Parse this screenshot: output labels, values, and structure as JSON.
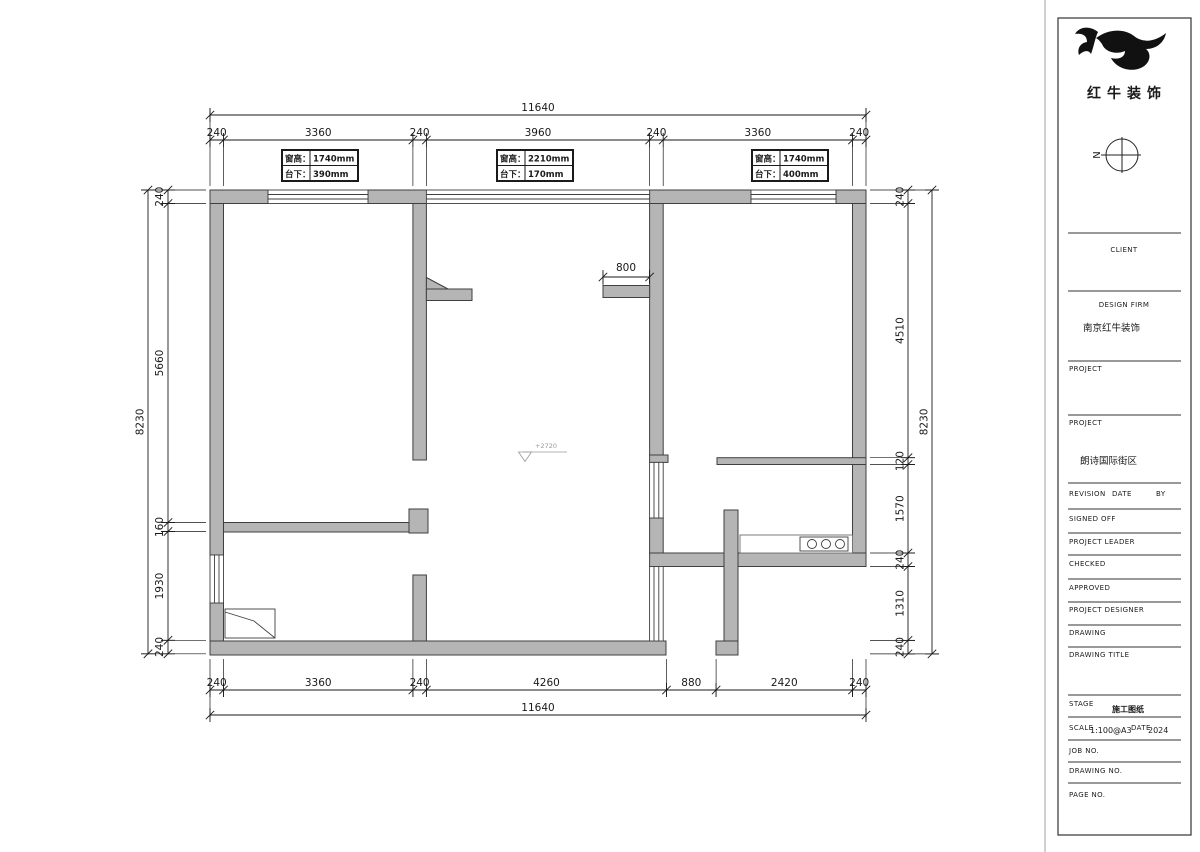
{
  "brand": {
    "company_name": "红牛装饰",
    "north_label": "N"
  },
  "dims": {
    "top_overall": "11640",
    "top_segments": [
      "240",
      "3360",
      "240",
      "3960",
      "240",
      "3360",
      "240"
    ],
    "bottom_segments": [
      "240",
      "3360",
      "240",
      "4260",
      "880",
      "2420",
      "240"
    ],
    "bottom_overall": "11640",
    "left_overall": "8230",
    "left_segments": [
      "240",
      "5660",
      "160",
      "1930",
      "240"
    ],
    "right_segments": [
      "240",
      "4510",
      "120",
      "1570",
      "240",
      "1310",
      "240"
    ],
    "right_overall": "8230",
    "interior_dim": "800"
  },
  "annotations": {
    "level_marker": "+2720"
  },
  "window_tags": [
    {
      "rows": [
        {
          "label": "窗高：",
          "value": "1740mm"
        },
        {
          "label": "台下：",
          "value": "390mm"
        }
      ]
    },
    {
      "rows": [
        {
          "label": "窗高：",
          "value": "2210mm"
        },
        {
          "label": "台下：",
          "value": "170mm"
        }
      ]
    },
    {
      "rows": [
        {
          "label": "窗高：",
          "value": "1740mm"
        },
        {
          "label": "台下：",
          "value": "400mm"
        }
      ]
    }
  ],
  "title_block": {
    "client_label": "CLIENT",
    "design_firm_label": "DESIGN FIRM",
    "design_firm_value": "南京红牛装饰",
    "project1_label": "PROJECT",
    "project2_label": "PROJECT",
    "project2_value": "朗诗国际街区",
    "revision_label": "REVISION",
    "date_label": "DATE",
    "by_label": "BY",
    "signed_off_label": "SIGNED OFF",
    "project_leader_label": "PROJECT LEADER",
    "checked_label": "CHECKED",
    "approved_label": "APPROVED",
    "project_designer_label": "PROJECT DESIGNER",
    "drawing_label": "DRAWING",
    "drawing_title_label": "DRAWING TITLE",
    "stage_label": "STAGE",
    "stage_value": "施工图纸",
    "scale_label": "SCALE",
    "scale_value": "1:100@A3",
    "date2_label": "DATE",
    "date_value": "2024",
    "job_no_label": "JOB NO.",
    "drawing_no_label": "DRAWING NO.",
    "page_no_label": "PAGE NO."
  },
  "colors": {
    "wall_fill": "#b5b5b5",
    "wall_stroke": "#3f3f3f",
    "dim_line": "#1a1a1a",
    "level_gray": "#9a9a9a"
  }
}
